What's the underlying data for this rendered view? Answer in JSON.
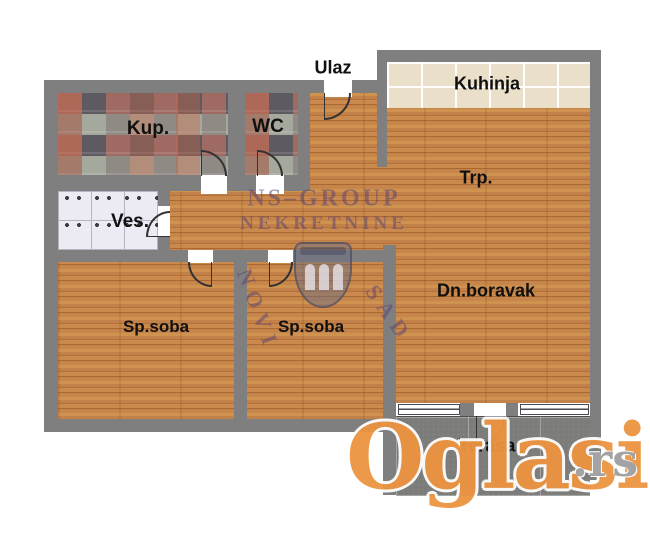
{
  "plan": {
    "entrance_label": "Ulaz",
    "rooms": [
      {
        "id": "kupatilo",
        "label": "Kup."
      },
      {
        "id": "wc",
        "label": "WC"
      },
      {
        "id": "vesernica",
        "label": "Ves."
      },
      {
        "id": "kuhinja",
        "label": "Kuhinja"
      },
      {
        "id": "trpezarija",
        "label": "Trp."
      },
      {
        "id": "dnevni-boravak",
        "label": "Dn.boravak"
      },
      {
        "id": "spavaca-soba-1",
        "label": "Sp.soba"
      },
      {
        "id": "spavaca-soba-2",
        "label": "Sp.soba"
      },
      {
        "id": "terasa",
        "label": "Terasa"
      }
    ],
    "colors": {
      "wall": "#7f7f7f",
      "wood_floor": "#c28148",
      "kitchen_tile": "#eae0ca",
      "bath_tile_accent": "#9e6a62",
      "laundry_tile": "#eceaf2",
      "terrace_tile": "#7c7c7a"
    }
  },
  "watermarks": {
    "agency_name": "NS–GROUP",
    "agency_type": "NEKRETNINE",
    "agency_city_left": "NOVI",
    "agency_city_right": "SAD",
    "portal_name": "Oglasi",
    "portal_tld": ".rs",
    "colors": {
      "agency_purple": "#5f4673",
      "portal_orange": "#ec9440"
    }
  }
}
